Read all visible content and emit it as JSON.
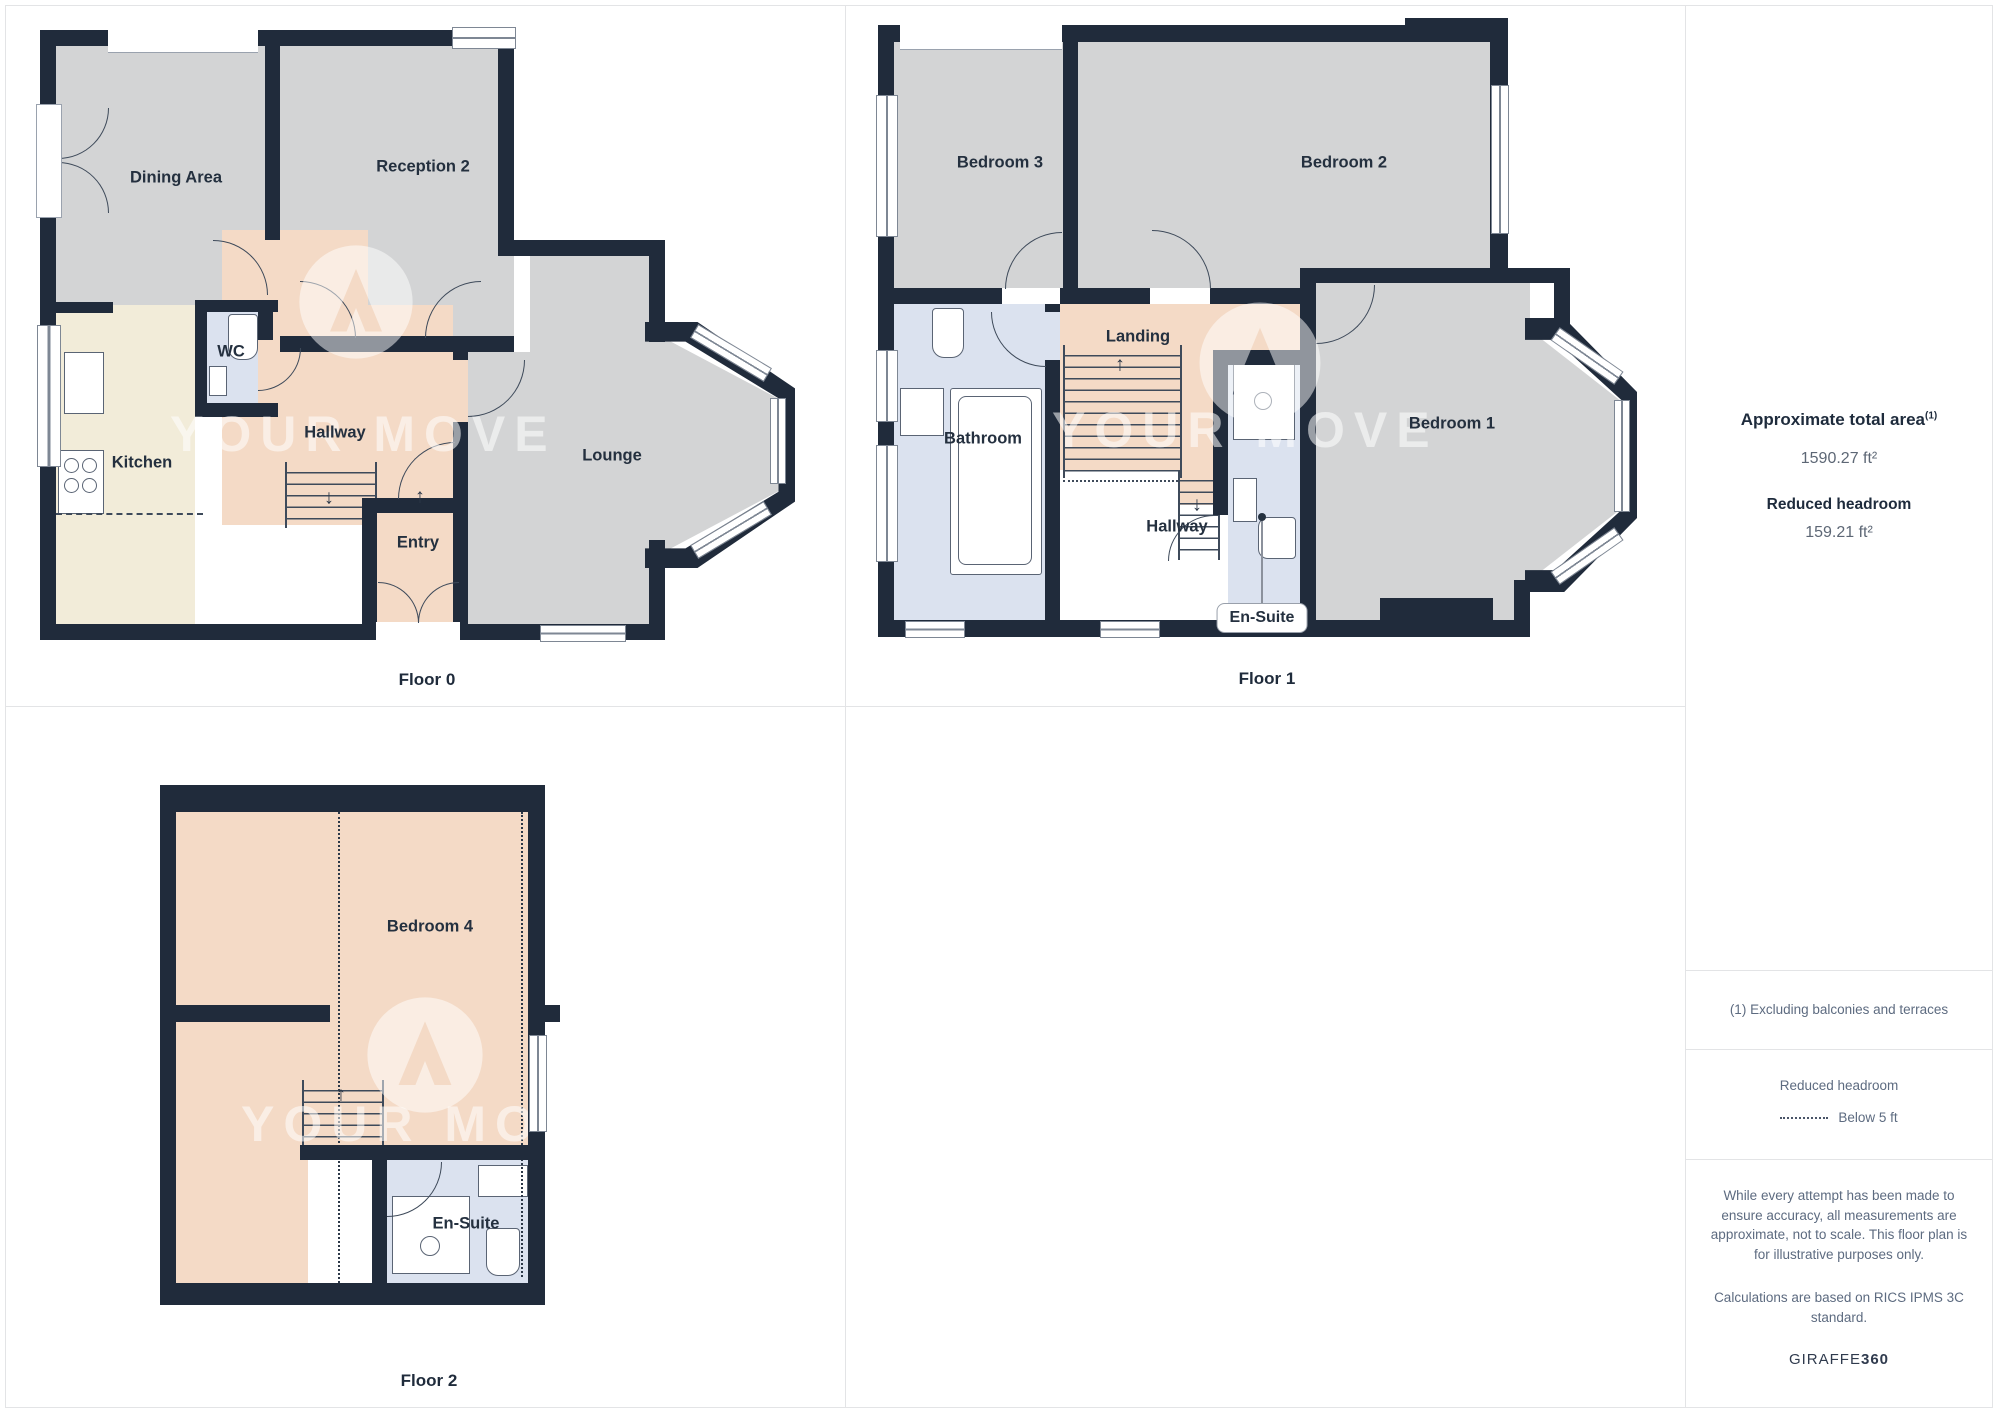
{
  "watermark": {
    "text": "YOUR MOVE"
  },
  "panel": {
    "title": "Approximate total area",
    "title_sup": "(1)",
    "total_area_value": "1590.27 ft²",
    "headroom_label": "Reduced headroom",
    "headroom_value": "159.21 ft²",
    "footnote": "(1) Excluding balconies and terraces",
    "legend_title": "Reduced headroom",
    "legend_item": "Below 5 ft",
    "disclaimer_1": "While every attempt has been made to ensure accuracy, all measurements are approximate, not to scale. This floor plan is for illustrative purposes only.",
    "disclaimer_2": "Calculations are based on RICS IPMS 3C standard.",
    "brand_name": "GIRAFFE",
    "brand_suffix": "360"
  },
  "floors": [
    {
      "caption": "Floor 0",
      "rooms": {
        "dining": "Dining Area",
        "reception": "Reception 2",
        "wc": "WC",
        "kitchen": "Kitchen",
        "hallway": "Hallway",
        "entry": "Entry",
        "lounge": "Lounge"
      }
    },
    {
      "caption": "Floor 1",
      "rooms": {
        "bedroom3": "Bedroom 3",
        "bedroom2": "Bedroom 2",
        "landing": "Landing",
        "bathroom": "Bathroom",
        "hallway": "Hallway",
        "bedroom1": "Bedroom 1",
        "ensuite": "En-Suite"
      }
    },
    {
      "caption": "Floor 2",
      "rooms": {
        "bedroom4": "Bedroom 4",
        "ensuite": "En-Suite"
      }
    }
  ],
  "colors": {
    "wall": "#202b3b",
    "gray_room": "#d3d4d5",
    "peach_room": "#f4dac6",
    "cream_room": "#f2ecd9",
    "blue_room": "#dbe2ef",
    "divider": "#e3e4e6",
    "label_text": "#24303f",
    "panel_text": "#5d6b80"
  }
}
